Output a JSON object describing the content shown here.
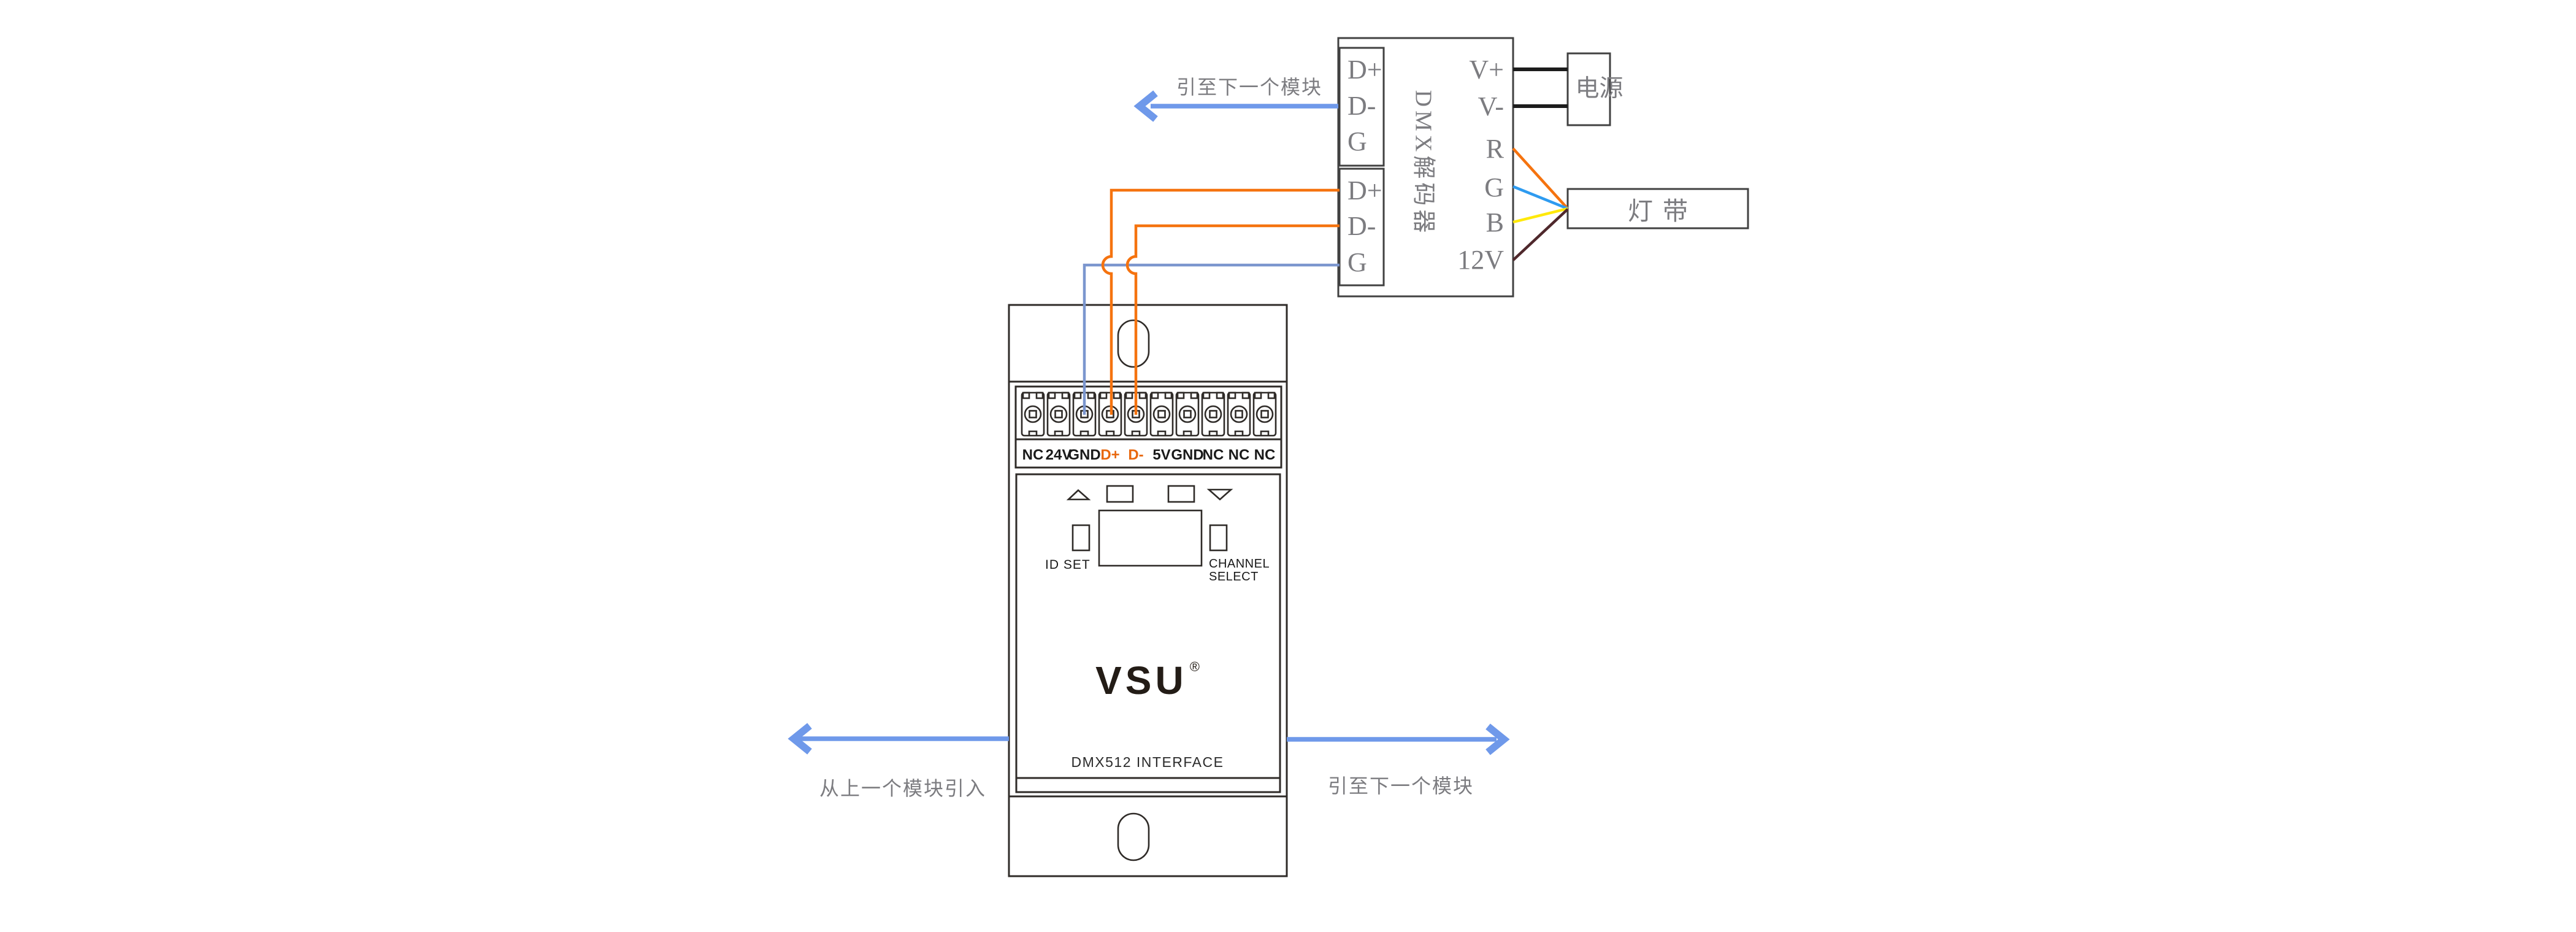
{
  "diagram": {
    "decoder": {
      "title_vertical": "DMX解码器",
      "left_groups": [
        {
          "pins": [
            "D+",
            "D-",
            "G"
          ]
        },
        {
          "pins": [
            "D+",
            "D-",
            "G"
          ]
        }
      ],
      "right_pins": [
        "V+",
        "V-",
        "R",
        "G",
        "B",
        "12V"
      ]
    },
    "power_supply": {
      "label": "电源"
    },
    "led_strip": {
      "label": "灯带"
    },
    "module": {
      "brand": "VSU",
      "registered_mark": "®",
      "product_label": "DMX512 INTERFACE",
      "id_set_label": "ID SET",
      "channel_select_line1": "CHANNEL",
      "channel_select_line2": "SELECT",
      "terminals": [
        {
          "label": "NC",
          "color": "#1a1a1a"
        },
        {
          "label": "24V",
          "color": "#1a1a1a"
        },
        {
          "label": "GND",
          "color": "#1a1a1a"
        },
        {
          "label": "D+",
          "color": "#e8680f"
        },
        {
          "label": "D-",
          "color": "#e8680f"
        },
        {
          "label": "5V",
          "color": "#1a1a1a"
        },
        {
          "label": "GND",
          "color": "#1a1a1a"
        },
        {
          "label": "NC",
          "color": "#1a1a1a"
        },
        {
          "label": "NC",
          "color": "#1a1a1a"
        },
        {
          "label": "NC",
          "color": "#1a1a1a"
        }
      ]
    },
    "annotations": {
      "to_next_module_top": "引至下一个模块",
      "from_previous_module": "从上一个模块引入",
      "to_next_module_bottom": "引至下一个模块"
    },
    "wire_colors": {
      "arrow_blue": "#6f99ea",
      "signal_blue_gray": "#7b96ce",
      "orange": "#f5730f",
      "power_black": "#1c1c1c",
      "r_wire": "#f5730f",
      "g_wire": "#2e9bf0",
      "b_wire": "#ffe90a",
      "v12_wire": "#4f282c"
    },
    "text_gray": "#7c7c80"
  }
}
